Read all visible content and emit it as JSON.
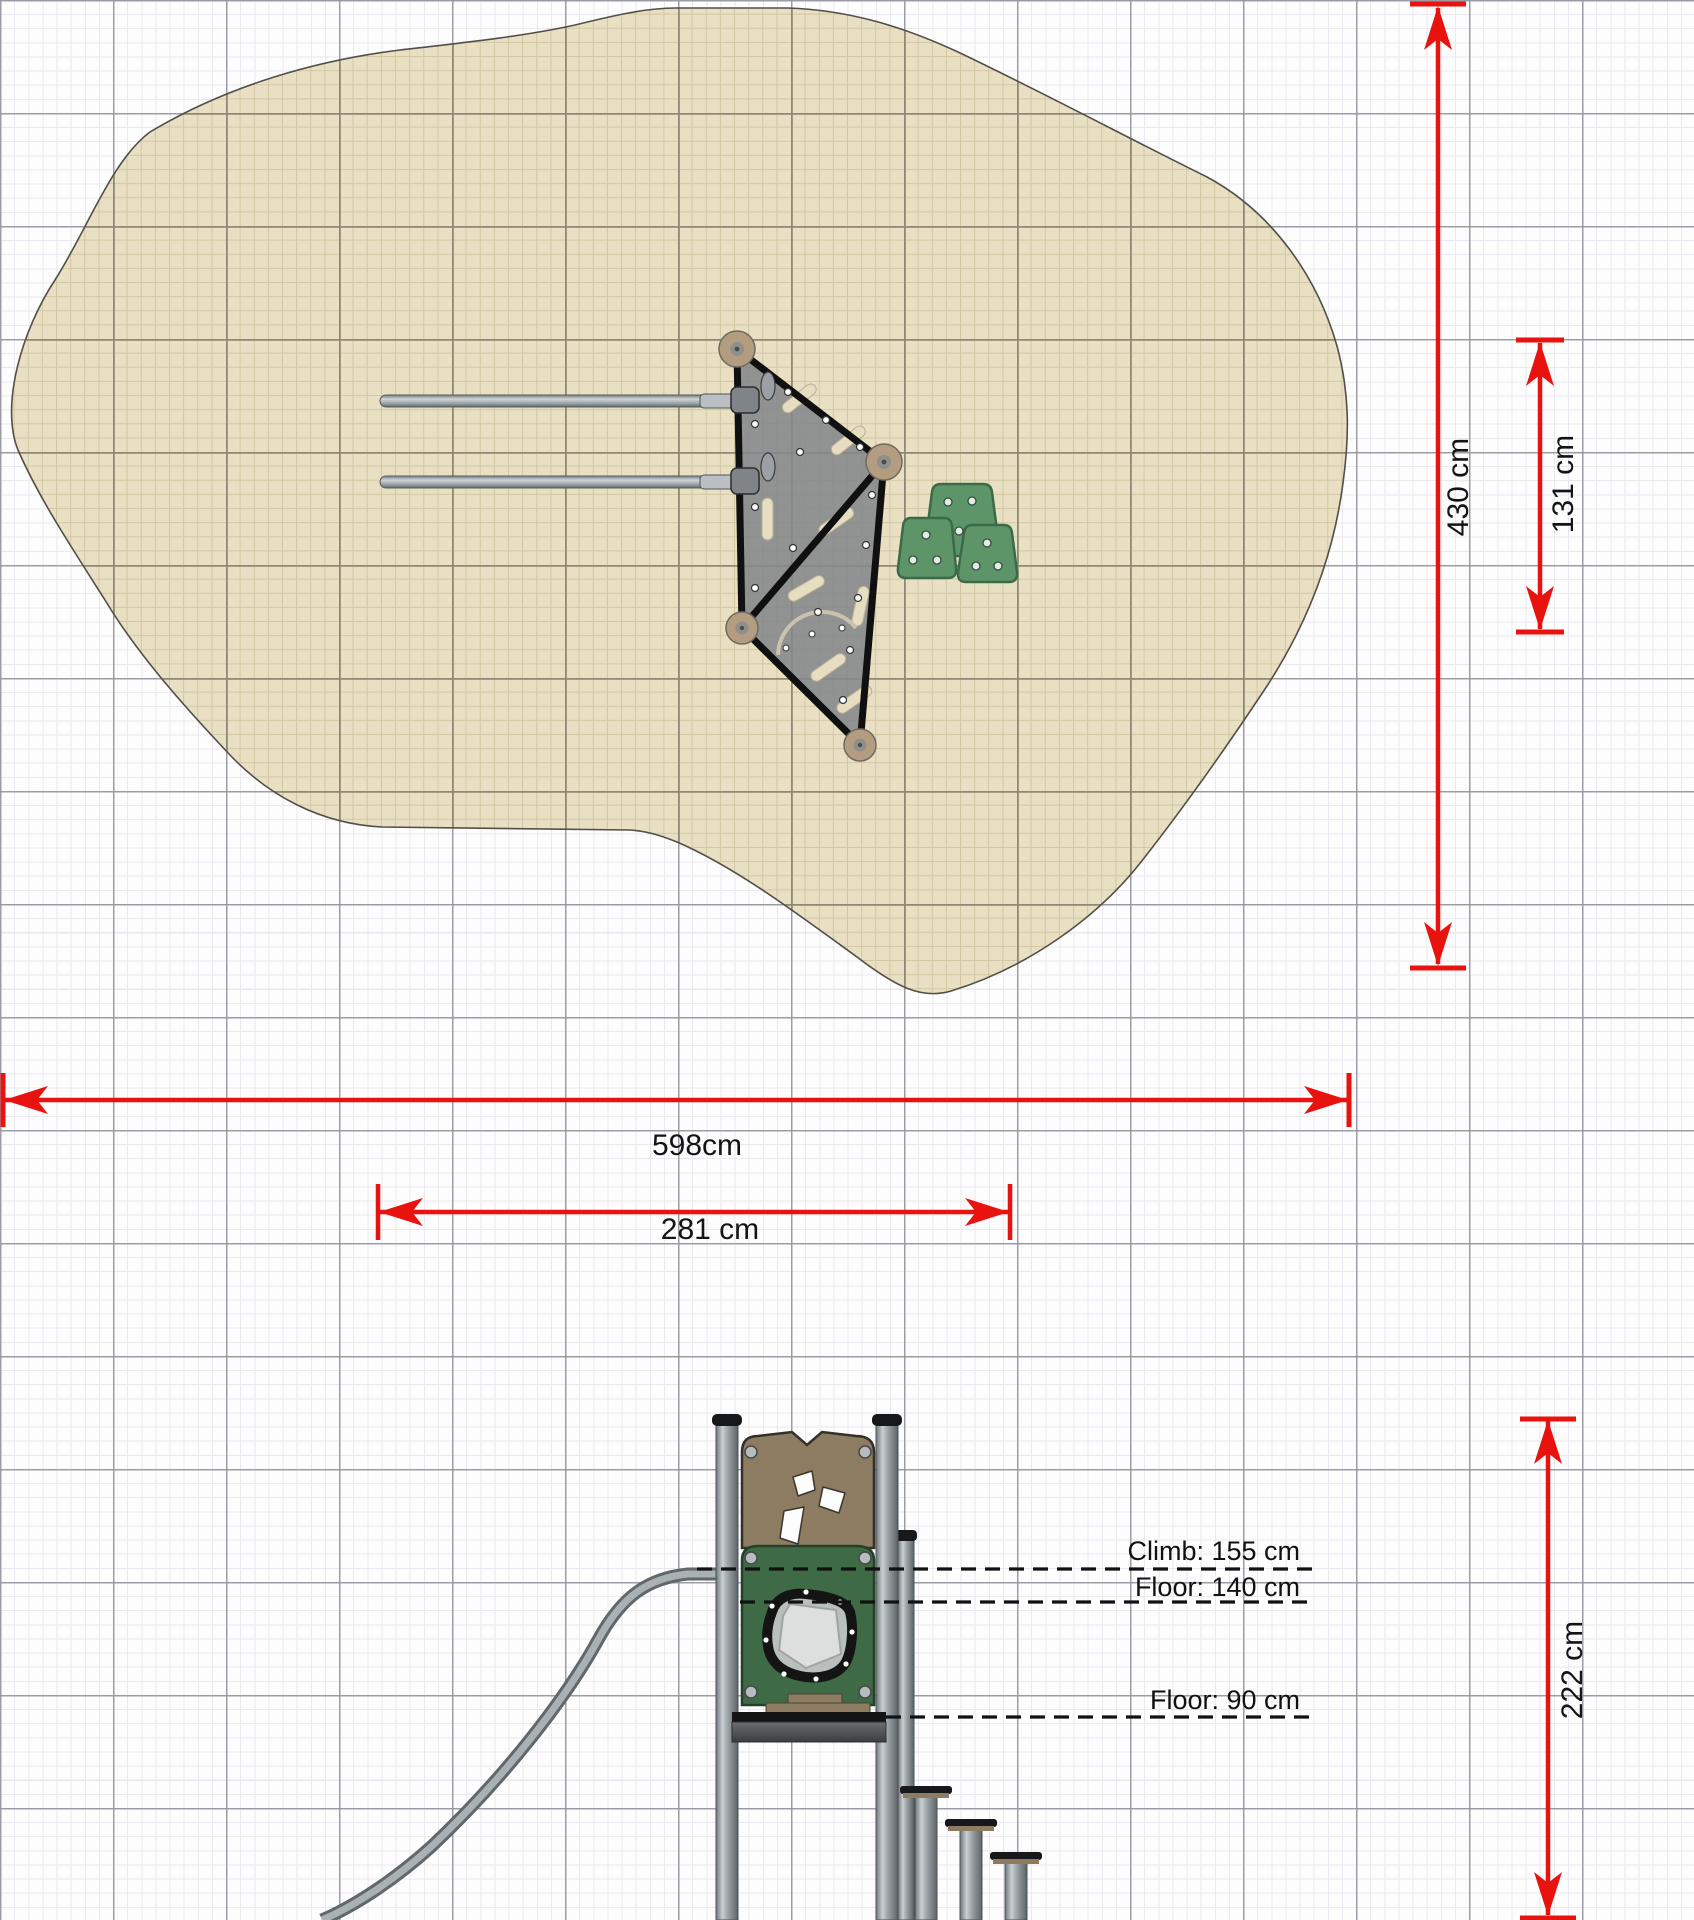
{
  "plan": {
    "dim_total_width": "598cm",
    "dim_total_depth": "430 cm",
    "dim_inner_width": "281 cm",
    "dim_inner_depth": "131 cm"
  },
  "elevation": {
    "dim_height": "222 cm",
    "label_climb": "Climb: 155 cm",
    "label_floor_upper": "Floor: 140 cm",
    "label_floor_lower": "Floor: 90 cm"
  },
  "colors": {
    "dimension_red": "#e8120f",
    "sand_fill": "#e9dfc2",
    "sand_grid_minor": "#d3c8a5",
    "sand_grid_major": "#8e8874",
    "panel_brown": "#8d7c61",
    "panel_green": "#3e6b45",
    "pad_green": "#5e9568",
    "metal_gray": "#9aa2a6",
    "frame_black": "#101010"
  }
}
